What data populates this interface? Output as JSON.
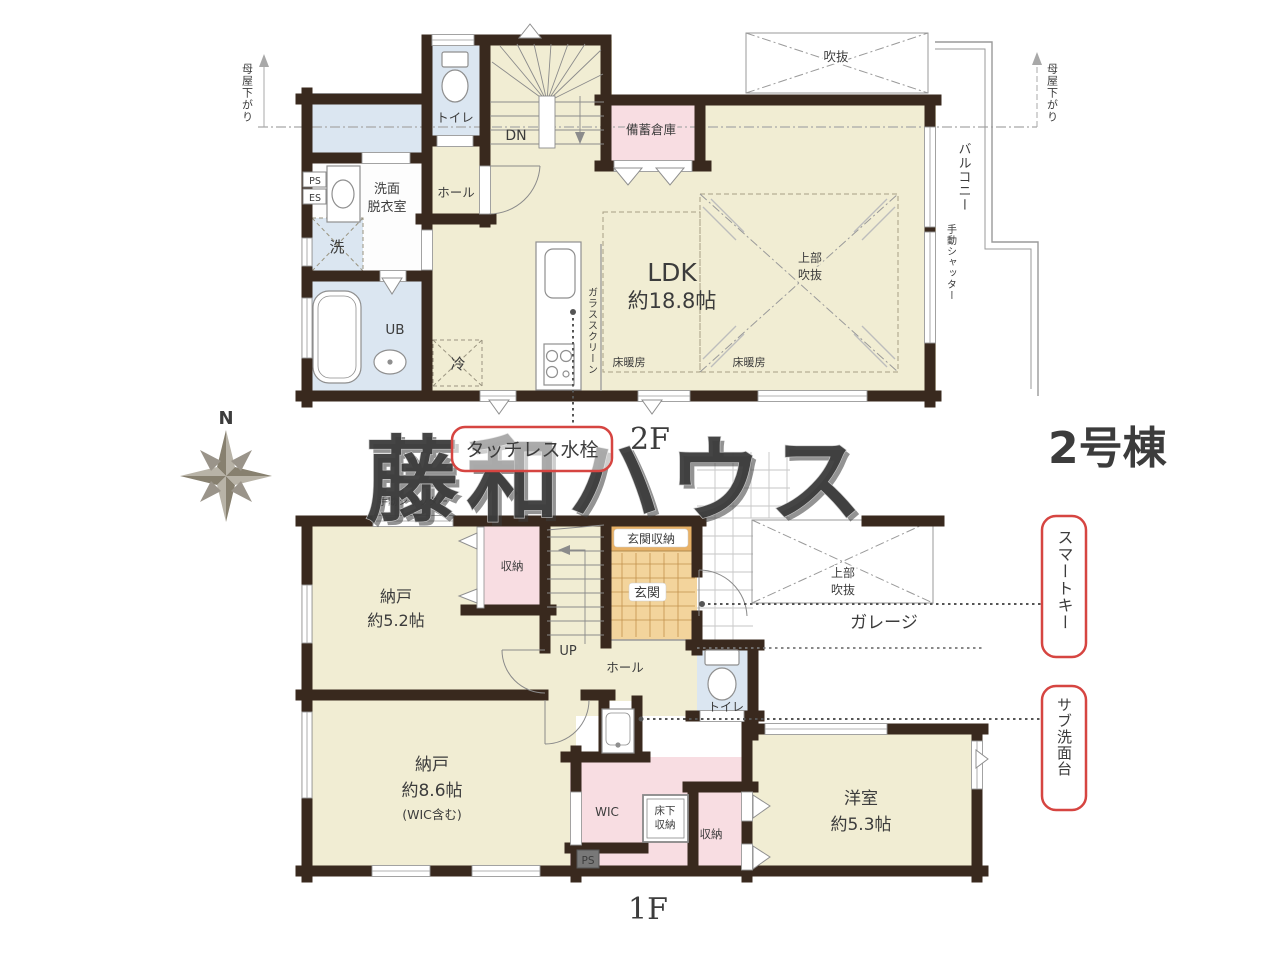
{
  "building_label": "2号棟",
  "watermark": "藤和ハウス",
  "compass": {
    "north_label": "N"
  },
  "colors": {
    "wall": "#39291e",
    "room_cream": "#f1edd3",
    "room_blue": "#dbe6f1",
    "room_pink": "#f8dde2",
    "entrance_storage_orange": "#e8b166",
    "entrance_tile": "#f3d49c",
    "annotation_red": "#d64541",
    "building_label_navy": "#1c2b7c",
    "watermark_gray": "#c9c9c9"
  },
  "floor2": {
    "floor_label": "2F",
    "ldk_l1": "LDK",
    "ldk_l2": "約18.8帖",
    "toilet": "トイレ",
    "hall": "ホール",
    "stairs_down": "DN",
    "stock_room": "備蓄倉庫",
    "washroom_l1": "洗面",
    "washroom_l2": "脱衣室",
    "laundry": "洗",
    "bath": "UB",
    "fridge": "冷",
    "floor_heating_left": "床暖房",
    "floor_heating_right": "床暖房",
    "upper_void_l1": "上部",
    "upper_void_l2": "吹抜",
    "void": "吹抜",
    "balcony": "バルコニー",
    "glass_screen": "ガラススクリーン",
    "manual_shutter": "手動シャッター",
    "moya_sagari_left": "母屋下がり",
    "moya_sagari_right": "母屋下がり",
    "ps": "PS",
    "es": "ES",
    "touchless_faucet": "タッチレス水栓"
  },
  "floor1": {
    "floor_label": "1F",
    "manual_shutter": "手動シャッター",
    "storeroom_small_l1": "納戸",
    "storeroom_small_l2": "約5.2帖",
    "closet_upper": "収納",
    "stairs_up": "UP",
    "hall": "ホール",
    "entrance_storage": "玄関収納",
    "entrance": "玄関",
    "upper_void_l1": "上部",
    "upper_void_l2": "吹抜",
    "garage": "ガレージ",
    "toilet": "トイレ",
    "storeroom_large_l1": "納戸",
    "storeroom_large_l2": "約8.6帖",
    "storeroom_large_l3": "(WIC含む)",
    "wic": "WIC",
    "underfloor_l1": "床下",
    "underfloor_l2": "収納",
    "closet_lower": "収納",
    "ps": "PS",
    "western_room_l1": "洋室",
    "western_room_l2": "約5.3帖",
    "smart_key": "スマートキー",
    "sub_washstand": "サブ洗面台"
  }
}
